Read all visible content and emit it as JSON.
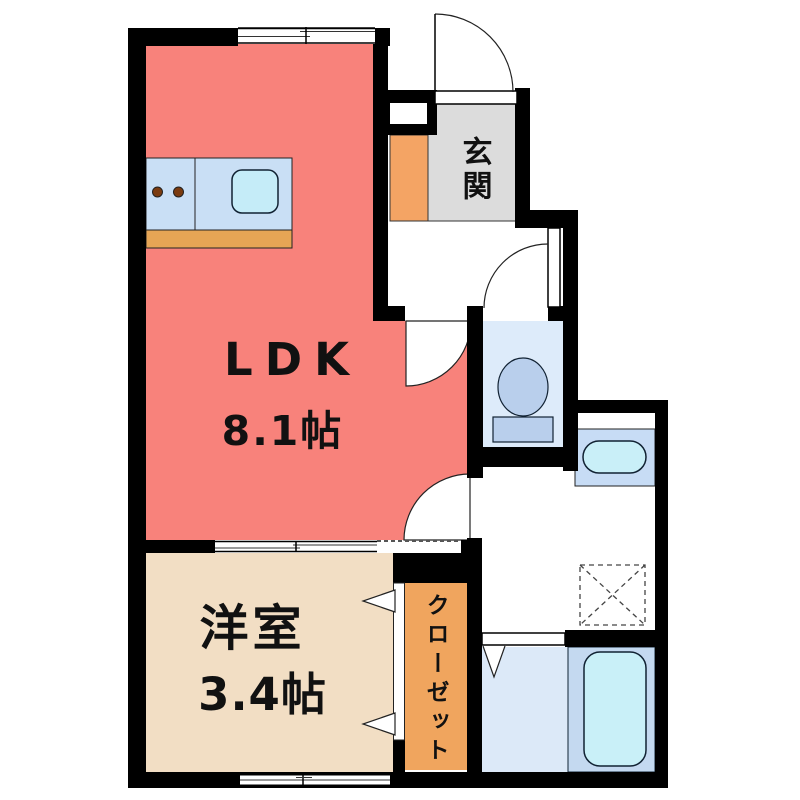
{
  "plan_title": "1K apartment floor plan",
  "rooms": {
    "ldk": {
      "name": "LDK",
      "size": "8.1帖"
    },
    "western_room": {
      "name": "洋室",
      "size": "3.4帖"
    },
    "entrance": {
      "name": "玄関"
    },
    "closet": {
      "name": "クローゼット"
    }
  },
  "fixtures": [
    "kitchen-counter",
    "stove-knobs",
    "kitchen-sink",
    "toilet",
    "wash-basin",
    "washing-machine-space",
    "bathtub",
    "entrance-door-swing",
    "room-door-swings",
    "sliding-doors",
    "folding-doors",
    "windows"
  ],
  "colors": {
    "wall": "#000000",
    "ldk_floor": "#F8827B",
    "western_room_floor": "#F2DEC4",
    "entrance_floor": "#DCDCDC",
    "entrance_step": "#F4A464",
    "closet_floor": "#F0A55E",
    "kitchen_counter": "#C9DFF5",
    "kitchen_cabinet": "#E6A555",
    "kitchen_sink": "#C5ECF8",
    "stove_knob": "#7A3B10",
    "toilet_room_floor": "#DDEBFA",
    "toilet_fixture": "#B9CFEC",
    "vanity_unit": "#C7DCF5",
    "vanity_basin": "#C9EFF8",
    "bathroom_floor_left": "#DCE9F8",
    "bathroom_floor_right": "#C4D9F0",
    "bathtub": "#C9F0F8"
  }
}
